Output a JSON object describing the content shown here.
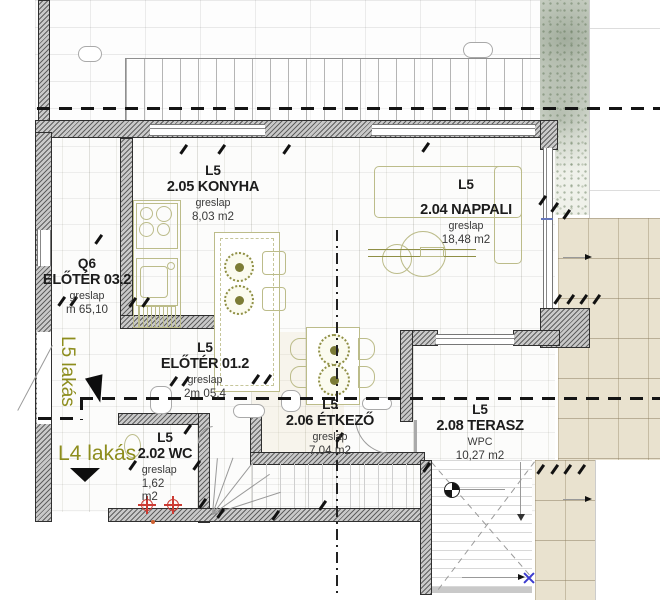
{
  "plan": {
    "apartment_labels": {
      "l5": "L5 lakás",
      "l4": "L4 lakás"
    },
    "rooms": [
      {
        "unit": "L5",
        "name": "2.05 KONYHA",
        "finish": "greslap",
        "area": "8,03 m2"
      },
      {
        "unit": "L5",
        "name": "2.04 NAPPALI",
        "finish": "greslap",
        "area": "18,48 m2"
      },
      {
        "unit": "Q6",
        "name": "ELŐTÉR 03.2",
        "finish": "greslap",
        "area": "m 65,10"
      },
      {
        "unit": "L5",
        "name": "ELŐTÉR 01.2",
        "finish": "greslap",
        "area": "2m 05,4"
      },
      {
        "unit": "L5",
        "name": "2.06 ÉTKEZŐ",
        "finish": "greslap",
        "area": "7,04 m2"
      },
      {
        "unit": "L5",
        "name": "2.02 WC",
        "finish": "greslap",
        "area": "1,62",
        "area_unit": "m2"
      },
      {
        "unit": "L5",
        "name": "2.08 TERASZ",
        "finish": "WPC",
        "area": "10,27 m2"
      }
    ],
    "colors": {
      "furniture_olive": "#8f8f45",
      "apartment_label_olive": "#8d8d1d",
      "terrace_beige": "#e9e2cf",
      "wall_gray": "#c9c9c9",
      "section_line": "#141414",
      "plumbing_red": "#cc3b33",
      "reference_blue": "#3b3bcf"
    }
  }
}
